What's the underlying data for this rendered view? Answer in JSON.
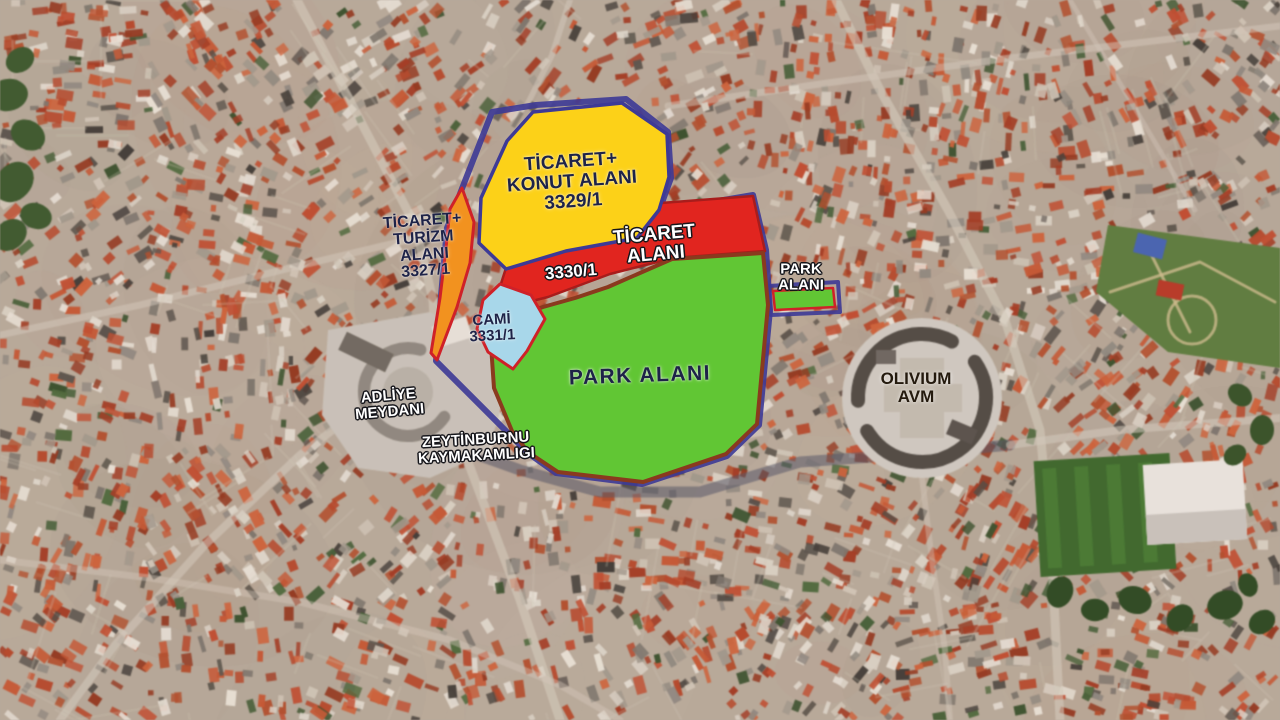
{
  "colors": {
    "boundary": "#3d3a96",
    "red_outline": "#cf2128",
    "dark_red_outline": "#a81d1c",
    "park_outline": "#8a3a1e"
  },
  "zones": {
    "ticaret_konut": {
      "lines": [
        "TİCARET+",
        "KONUT ALANI",
        "3329/1"
      ],
      "color": "#fcd118"
    },
    "ticaret_turizm": {
      "lines": [
        "TİCARET+",
        "TURİZM",
        "ALANI",
        "3327/1"
      ],
      "color": "#f2921f"
    },
    "ticaret": {
      "lines": [
        "TİCARET",
        "ALANI"
      ],
      "parcel": "3330/1",
      "color": "#e1251f"
    },
    "cami": {
      "lines": [
        "CAMİ",
        "3331/1"
      ],
      "color": "#a8d7ea"
    },
    "park_main": {
      "lines": [
        "PARK ALANI"
      ],
      "color": "#61c634"
    },
    "park_small": {
      "lines": [
        "PARK",
        "ALANI"
      ],
      "color": "#61c634"
    }
  },
  "places": {
    "adliye": {
      "lines": [
        "ADLİYE",
        "MEYDANI"
      ]
    },
    "kaymakamlik": {
      "lines": [
        "ZEYTİNBURNU",
        "KAYMAKAMLIGI"
      ]
    },
    "olivium": {
      "lines": [
        "OLIVIUM",
        "AVM"
      ]
    }
  }
}
